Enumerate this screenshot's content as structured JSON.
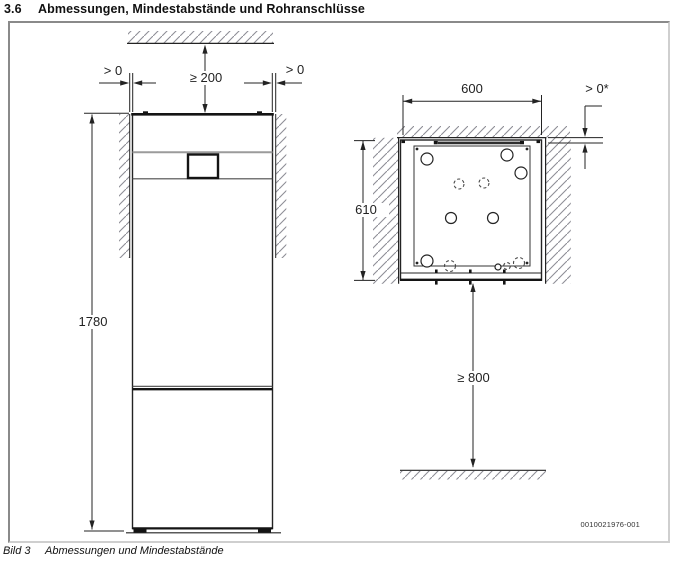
{
  "page": {
    "heading": {
      "number": "3.6",
      "title": "Abmessungen, Mindestabstände und Rohranschlüsse"
    },
    "caption": {
      "label": "Bild 3",
      "text": "Abmessungen und Mindestabstände"
    },
    "doc_number": "0010021976-001"
  },
  "front_view": {
    "ceiling_clearance": "≥ 200",
    "left_wall_clearance": "> 0",
    "right_wall_clearance": "> 0",
    "unit_height": "1780"
  },
  "top_view": {
    "unit_width": "600",
    "rear_wall_clearance": "> 0*",
    "unit_depth": "610",
    "front_service_clearance": "≥ 800"
  },
  "colors": {
    "line": "#232323",
    "hatch": "#8e8e96",
    "frame_border": "#8a8a8a"
  }
}
